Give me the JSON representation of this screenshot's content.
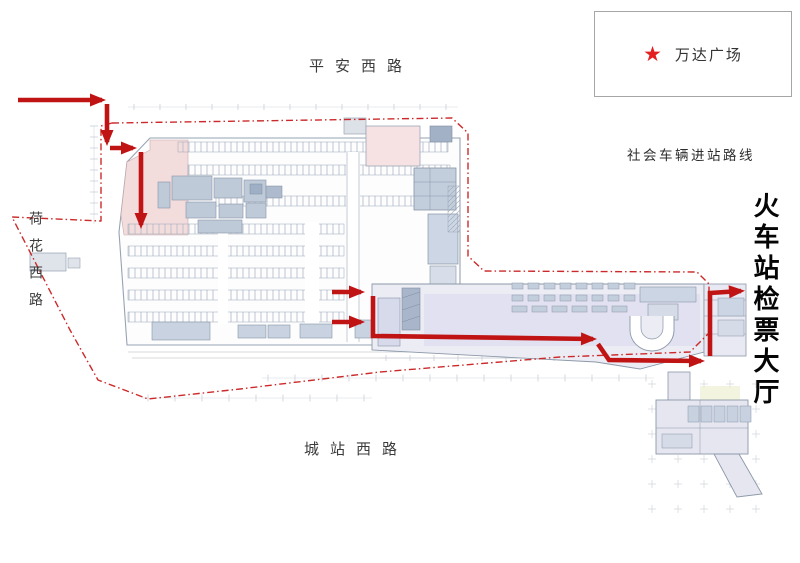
{
  "legend": {
    "star_icon": "★",
    "label": "万达广场"
  },
  "roads": {
    "top": "平安西路",
    "left": "荷花西路",
    "bottom": "城站西路"
  },
  "annotations": {
    "vehicle_route_note": "社会车辆进站路线",
    "destination": "火车站检票大厅"
  },
  "colors": {
    "route_red": "#c01414",
    "dash_red": "#cc2a2a",
    "star_red": "#e31f1f"
  },
  "routes": {
    "thick_segments": [
      [
        [
          18,
          100
        ],
        [
          102,
          100
        ]
      ],
      [
        [
          107,
          104
        ],
        [
          107,
          142
        ]
      ],
      [
        [
          110,
          148
        ],
        [
          133,
          148
        ]
      ],
      [
        [
          141,
          152
        ],
        [
          141,
          225
        ]
      ],
      [
        [
          332,
          292
        ],
        [
          361,
          292
        ]
      ],
      [
        [
          332,
          322
        ],
        [
          361,
          322
        ]
      ],
      [
        [
          373,
          296
        ],
        [
          373,
          336
        ],
        [
          593,
          339
        ]
      ],
      [
        [
          598,
          344
        ],
        [
          609,
          360
        ],
        [
          701,
          361
        ]
      ],
      [
        [
          710,
          356
        ],
        [
          710,
          293
        ],
        [
          741,
          291
        ]
      ]
    ],
    "dashed_loop": [
      [
        112,
        123
      ],
      [
        452,
        118
      ],
      [
        468,
        133
      ],
      [
        468,
        256
      ],
      [
        484,
        271
      ],
      [
        697,
        272
      ],
      [
        709,
        284
      ],
      [
        709,
        333
      ],
      [
        690,
        352
      ],
      [
        560,
        357
      ],
      [
        380,
        372
      ],
      [
        240,
        389
      ],
      [
        148,
        399
      ],
      [
        98,
        380
      ],
      [
        70,
        330
      ],
      [
        12,
        217
      ],
      [
        101,
        221
      ],
      [
        101,
        126
      ]
    ]
  }
}
